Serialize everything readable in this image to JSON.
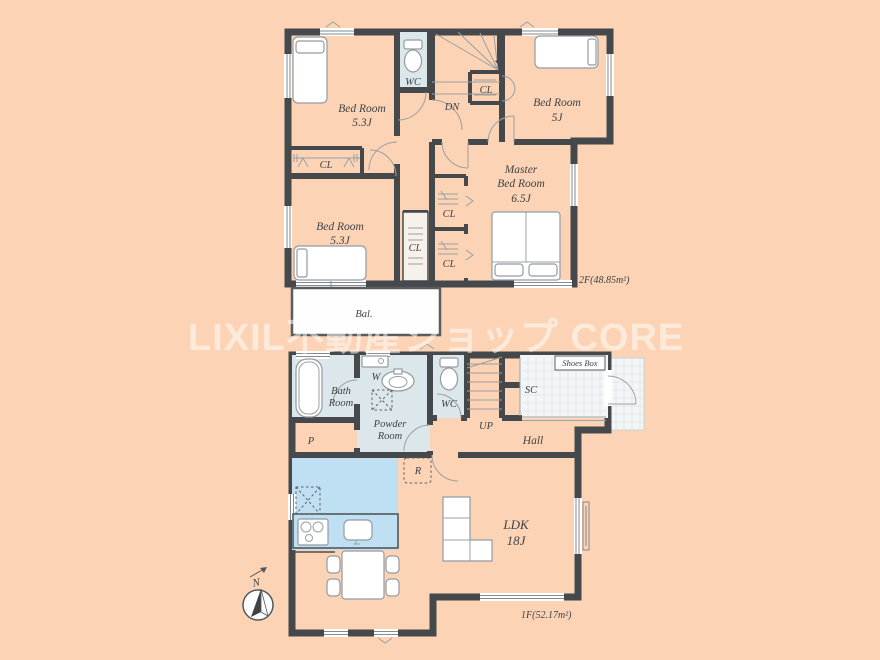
{
  "watermark": "LIXIL不動産ショップ CORE",
  "floor2": {
    "bedroom1": {
      "name": "Bed Room",
      "size": "5.3J"
    },
    "bedroom2": {
      "name": "Bed Room",
      "size": "5J"
    },
    "master": {
      "name1": "Master",
      "name2": "Bed Room",
      "size": "6.5J"
    },
    "bedroom3": {
      "name": "Bed Room",
      "size": "5.3J"
    },
    "wc": "WC",
    "stairs_down": "DN",
    "closet": "CL",
    "balcony": "Bal.",
    "area": "2F(48.85m²)"
  },
  "floor1": {
    "bath": {
      "name1": "Bath",
      "name2": "Room"
    },
    "washer": "W",
    "powder": {
      "name1": "Powder",
      "name2": "Room"
    },
    "wc": "WC",
    "stairs_up": "UP",
    "shoe_closet": "SC",
    "shoes_box": "Shoes Box",
    "hall": "Hall",
    "pantry": "P",
    "refrigerator": "R",
    "ldk": {
      "name": "LDK",
      "size": "18J"
    },
    "area": "1F(52.17m²)"
  },
  "compass": {
    "north": "N"
  },
  "colors": {
    "background": "#FCD3B4",
    "wall": "#45494C",
    "room": "#F6F1EA",
    "wet_area": "#DCE7EC",
    "kitchen": "#BFE0F2",
    "entrance_tile": "#F3F6F7",
    "watermark": "#FFFFFF"
  }
}
